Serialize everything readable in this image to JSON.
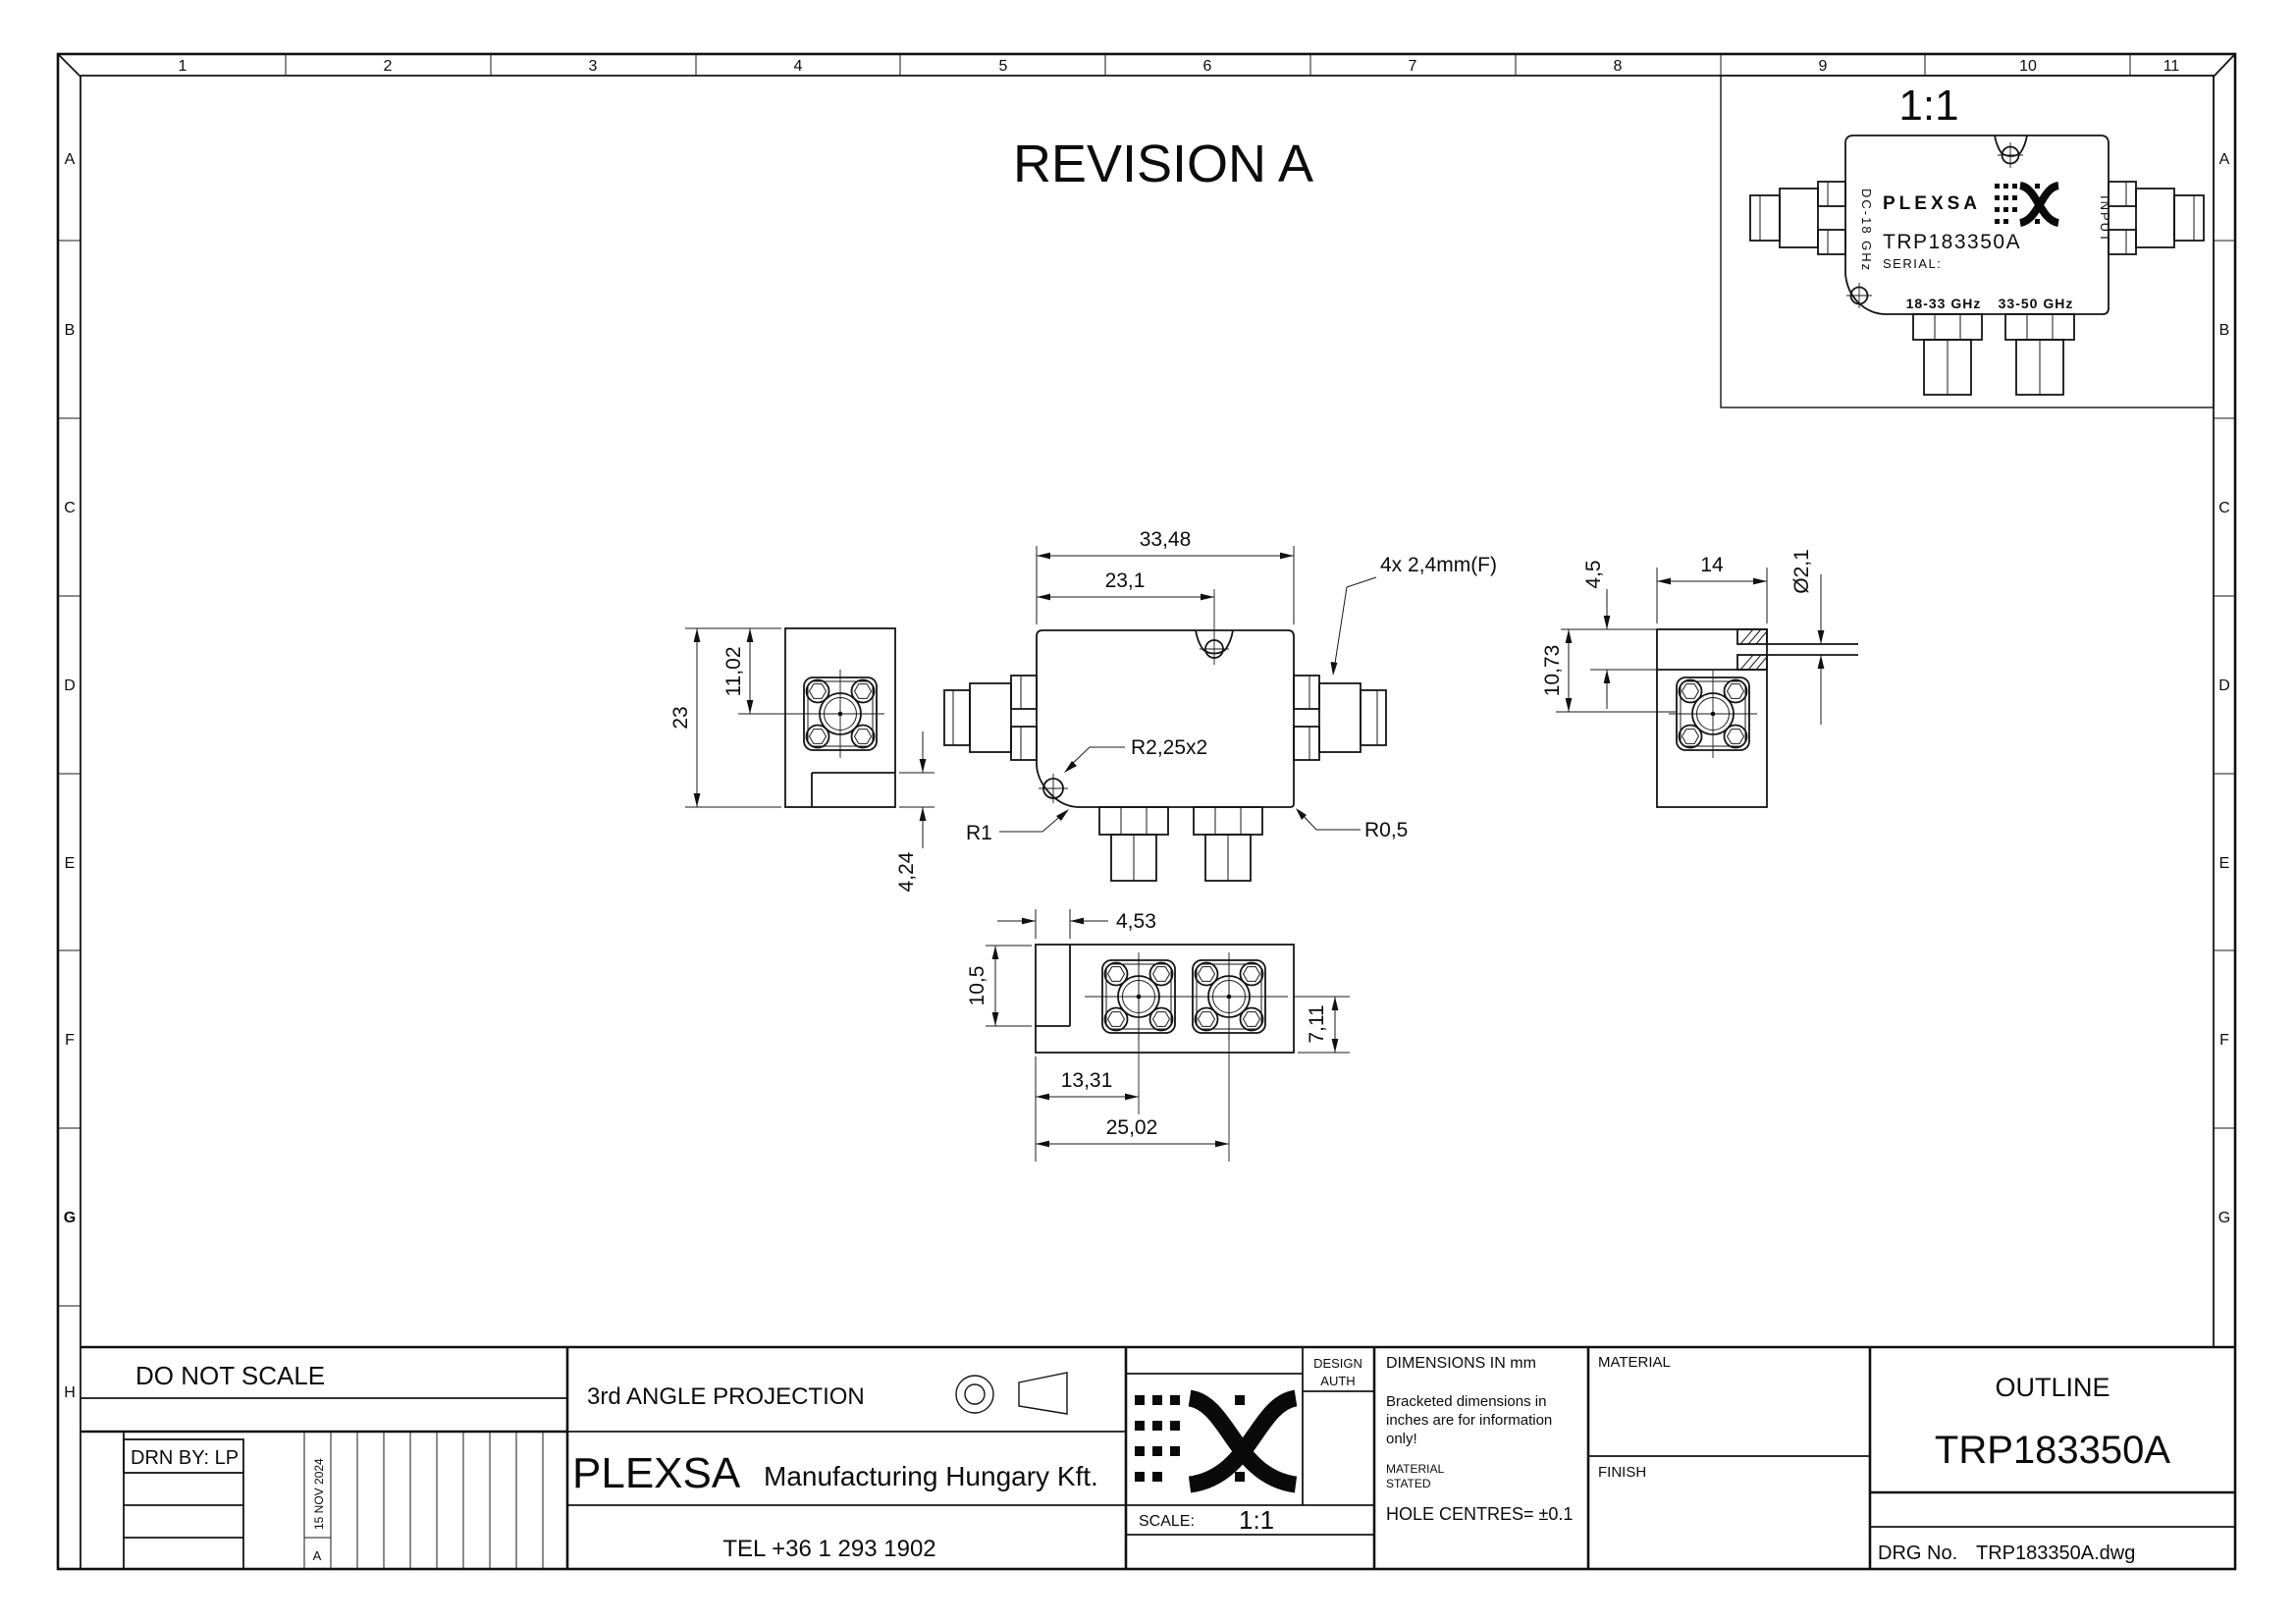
{
  "sheet": {
    "revision_title": "REVISION A",
    "grid_columns": [
      "1",
      "2",
      "3",
      "4",
      "5",
      "6",
      "7",
      "8",
      "9",
      "10",
      "11"
    ],
    "grid_rows_left": [
      "A",
      "B",
      "C",
      "D",
      "E",
      "F",
      "G",
      "H"
    ],
    "grid_rows_right": [
      "A",
      "B",
      "C",
      "D",
      "E",
      "F",
      "G"
    ]
  },
  "scale_view": {
    "scale_label": "1:1"
  },
  "device": {
    "brand": "PLEXSA",
    "model": "TRP183350A",
    "serial_label": "SERIAL:",
    "left_port_label": "DC-18 GHz",
    "input_label": "INPUT",
    "band_low": "18-33 GHz",
    "band_high": "33-50 GHz"
  },
  "dims": {
    "front_width": "33,48",
    "hole_offset": "23,1",
    "connector_note": "4x 2,4mm(F)",
    "tab_radius": "R2,25x2",
    "radius_r1": "R1",
    "radius_r05": "R0,5",
    "side_height": "23",
    "side_port_offset": "11,02",
    "side_notch": "4,24",
    "slot_depth": "4,5",
    "side_width": "14",
    "pin_diameter": "Ø2,1",
    "side_offset": "10,73",
    "notch_width": "4,53",
    "notch_depth": "10,5",
    "bottom_port_offset": "7,11",
    "port1_distance": "13,31",
    "port2_distance": "25,02"
  },
  "title_block": {
    "do_not_scale": "DO NOT SCALE",
    "drn_by": "DRN BY: LP",
    "rev_letter": "A",
    "rev_date": "15 NOV 2024",
    "projection": "3rd ANGLE PROJECTION",
    "company_name": "PLEXSA",
    "company_suffix": "Manufacturing Hungary Kft.",
    "tel": "TEL +36 1 293 1902",
    "design_label": "DESIGN",
    "auth_label": "AUTH",
    "scale_label": "SCALE:",
    "scale_value": "1:1",
    "notes_title": "DIMENSIONS IN mm",
    "note_bracket_1": "Bracketed dimensions in",
    "note_bracket_2": "inches are for information",
    "note_bracket_3": "only!",
    "note_material_1": "MATERIAL",
    "note_material_2": "STATED",
    "note_holes": "HOLE CENTRES= ±0.1",
    "material_label": "MATERIAL",
    "finish_label": "FINISH",
    "doc_title": "OUTLINE",
    "part_number": "TRP183350A",
    "drg_label": "DRG No.",
    "drg_value": "TRP183350A.dwg"
  }
}
